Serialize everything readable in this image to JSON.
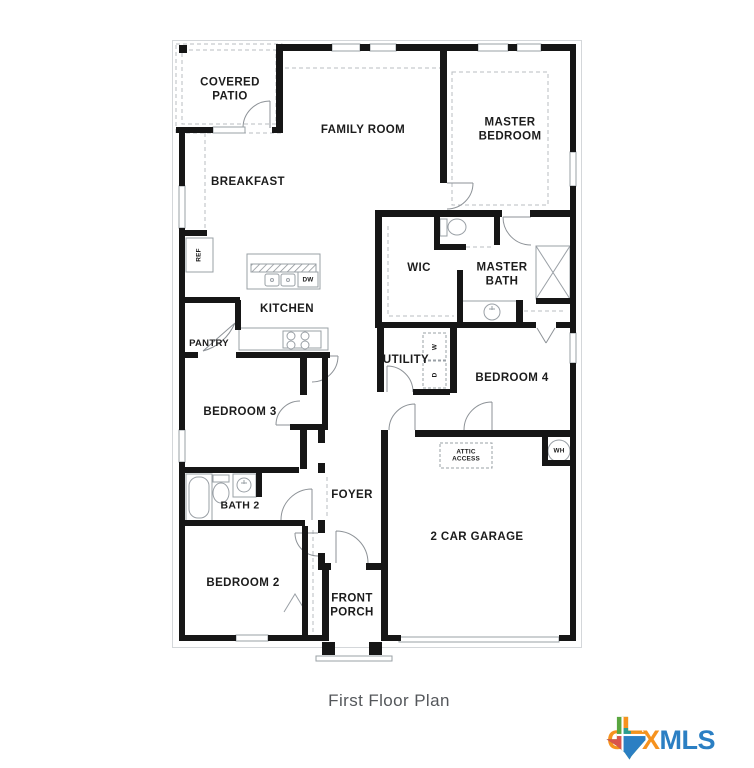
{
  "plan": {
    "labels": {
      "covered_patio": "COVERED PATIO",
      "family_room": "FAMILY ROOM",
      "master_bedroom": "MASTER BEDROOM",
      "breakfast": "BREAKFAST",
      "wic": "WIC",
      "master_bath": "MASTER BATH",
      "kitchen": "KITCHEN",
      "pantry": "PANTRY",
      "utility": "UTILITY",
      "bedroom4": "BEDROOM 4",
      "bedroom3": "BEDROOM 3",
      "bath2": "BATH 2",
      "foyer": "FOYER",
      "bedroom2": "BEDROOM 2",
      "front_porch": "FRONT PORCH",
      "garage": "2 CAR GARAGE",
      "attic_access": "ATTIC ACCESS",
      "wh": "WH",
      "ref": "REF",
      "dw": "DW",
      "washer": "W",
      "dryer": "D"
    },
    "caption": "First Floor Plan",
    "ink_color": "#161616"
  },
  "logo": {
    "ctx": "CTX",
    "mls": "MLS",
    "colors": {
      "ctx_orange": "#F6921E",
      "mls_blue": "#2B7FC3",
      "texas_green": "#59A63F",
      "texas_red": "#D9534A",
      "texas_teal": "#2A9D8F"
    }
  }
}
